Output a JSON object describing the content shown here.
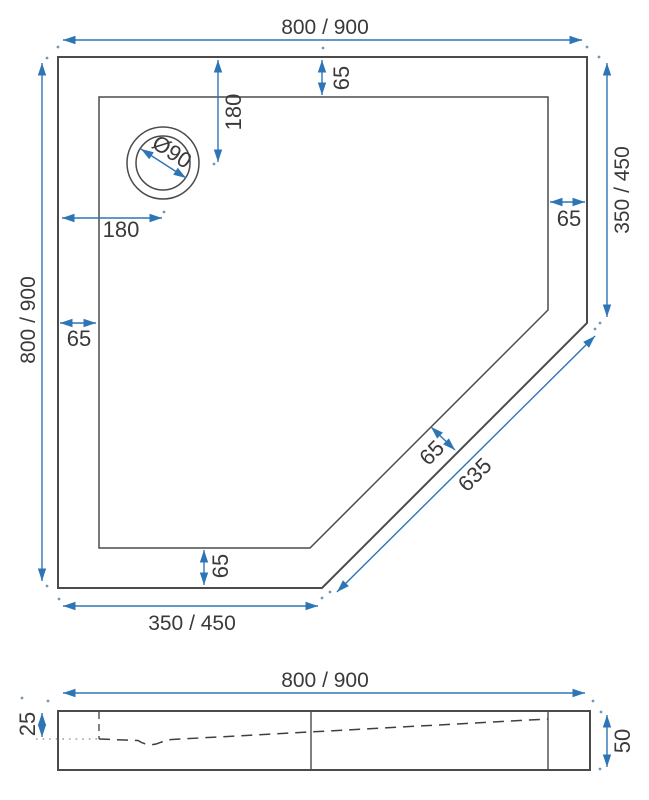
{
  "drawing_title": "Pentagonal shower tray dimensional drawing",
  "colors": {
    "dimension_blue": "#2e75b6",
    "outline_gray": "#4b4b4b",
    "label_dark": "#3a3a3a"
  },
  "top_view": {
    "width_top": "800 / 900",
    "height_left": "800 / 900",
    "side_right": "350 / 450",
    "side_bottom": "350 / 450",
    "diagonal_length": "635",
    "diagonal_rim": "65",
    "rim_top": "65",
    "rim_right": "65",
    "rim_left": "65",
    "rim_bottom": "65",
    "drain_offset_top": "180",
    "drain_offset_left": "180",
    "drain_diameter": "Ø90"
  },
  "side_view": {
    "width": "800 / 900",
    "ledge_depth": "25",
    "height": "50"
  }
}
